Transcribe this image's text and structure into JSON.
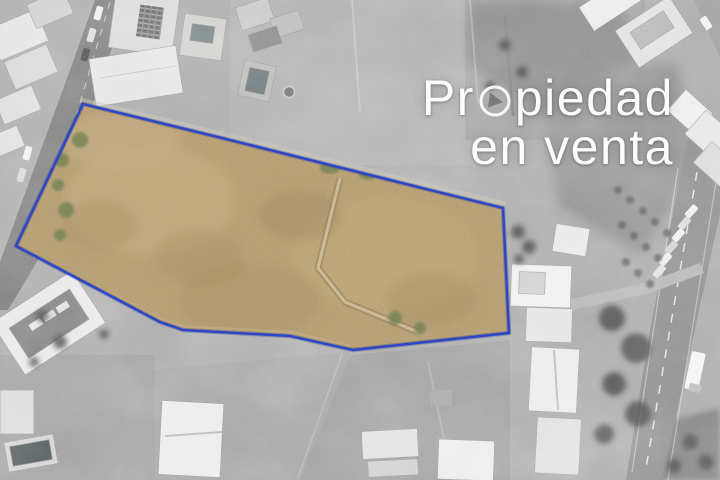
{
  "overlay": {
    "title_part1": "Pr",
    "title_part2": "piedad",
    "title_line2": "en venta",
    "o_icon": "compass-play-icon",
    "caption_color": "#ffffff"
  },
  "boundary": {
    "points": "83,104 230,140 430,190 503,208 509,333 353,350 290,336 183,330 160,322 16,246",
    "stroke_color": "#2b46c8",
    "halo_color": "#16247e"
  },
  "colors": {
    "photo_base": "#ababab",
    "parcel_fill": "#b49b6f"
  }
}
